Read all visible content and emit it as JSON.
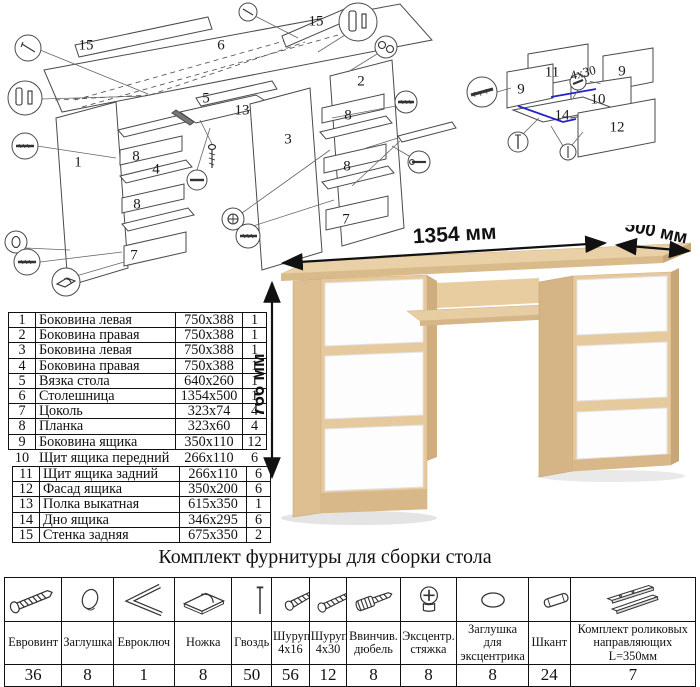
{
  "exploded_main": {
    "labels": [
      {
        "t": "15",
        "x": 86,
        "y": 46
      },
      {
        "t": "6",
        "x": 221,
        "y": 46
      },
      {
        "t": "15",
        "x": 316,
        "y": 22
      },
      {
        "t": "2",
        "x": 361,
        "y": 82
      },
      {
        "t": "5",
        "x": 206,
        "y": 99
      },
      {
        "t": "13",
        "x": 242,
        "y": 111
      },
      {
        "t": "3",
        "x": 288,
        "y": 140
      },
      {
        "t": "1",
        "x": 78,
        "y": 163
      },
      {
        "t": "4",
        "x": 156,
        "y": 170
      },
      {
        "t": "8",
        "x": 136,
        "y": 157
      },
      {
        "t": "8",
        "x": 137,
        "y": 205
      },
      {
        "t": "7",
        "x": 134,
        "y": 256
      },
      {
        "t": "8",
        "x": 348,
        "y": 116
      },
      {
        "t": "8",
        "x": 347,
        "y": 167
      },
      {
        "t": "7",
        "x": 346,
        "y": 220
      }
    ]
  },
  "exploded_drawer": {
    "labels": [
      {
        "t": "11",
        "x": 97,
        "y": 33
      },
      {
        "t": "9",
        "x": 66,
        "y": 50
      },
      {
        "t": "9",
        "x": 167,
        "y": 32
      },
      {
        "t": "10",
        "x": 143,
        "y": 60
      },
      {
        "t": "14",
        "x": 107,
        "y": 76
      },
      {
        "t": "12",
        "x": 162,
        "y": 88
      }
    ],
    "annotation": "4x30",
    "highlight_color": "#2323cc"
  },
  "parts_table": {
    "rows": [
      {
        "num": "1",
        "name": "Боковина левая",
        "size": "750x388",
        "qty": "1"
      },
      {
        "num": "2",
        "name": "Боковина правая",
        "size": "750x388",
        "qty": "1"
      },
      {
        "num": "3",
        "name": "Боковина левая",
        "size": "750x388",
        "qty": "1"
      },
      {
        "num": "4",
        "name": "Боковина правая",
        "size": "750x388",
        "qty": "1"
      },
      {
        "num": "5",
        "name": "Вязка стола",
        "size": "640x260",
        "qty": "1"
      },
      {
        "num": "6",
        "name": "Столешница",
        "size": "1354x500",
        "qty": "1"
      },
      {
        "num": "7",
        "name": "Цоколь",
        "size": "323x74",
        "qty": "4"
      },
      {
        "num": "8",
        "name": "Планка",
        "size": "323x60",
        "qty": "4"
      },
      {
        "num": "9",
        "name": "Боковина ящика",
        "size": "350x110",
        "qty": "12"
      },
      {
        "num": "10",
        "name": "Щит ящика передний",
        "size": "266x110",
        "qty": "6"
      },
      {
        "num": "11",
        "name": "Щит ящика задний",
        "size": "266x110",
        "qty": "6"
      },
      {
        "num": "12",
        "name": "Фасад ящика",
        "size": "350x200",
        "qty": "6"
      },
      {
        "num": "13",
        "name": "Полка выкатная",
        "size": "615x350",
        "qty": "1"
      },
      {
        "num": "14",
        "name": "Дно ящика",
        "size": "346x295",
        "qty": "6"
      },
      {
        "num": "15",
        "name": "Стенка задняя",
        "size": "675x350",
        "qty": "2"
      }
    ]
  },
  "desk": {
    "dims": {
      "width": "1354 мм",
      "depth": "500 мм",
      "height": "766 мм"
    },
    "wood_color": "#e6ca9e",
    "front_color": "#fdfdfd"
  },
  "hardware": {
    "title": "Комплект фурнитуры для сборки стола",
    "items": [
      {
        "icon": "euroscrew",
        "name": "Евровинт",
        "qty": "36"
      },
      {
        "icon": "cap",
        "name": "Заглушка",
        "qty": "8"
      },
      {
        "icon": "hexkey",
        "name": "Евроключ",
        "qty": "1"
      },
      {
        "icon": "foot",
        "name": "Ножка",
        "qty": "8"
      },
      {
        "icon": "nail",
        "name": "Гвоздь",
        "qty": "50"
      },
      {
        "icon": "screw_small",
        "name": "Шуруп 4x16",
        "qty": "56"
      },
      {
        "icon": "screw_long",
        "name": "Шуруп 4x30",
        "qty": "12"
      },
      {
        "icon": "dowel_screw",
        "name": "Ввинчив. дюбель",
        "qty": "8"
      },
      {
        "icon": "cam",
        "name": "Эксцентр. стяжка",
        "qty": "8"
      },
      {
        "icon": "cam_cap",
        "name": "Заглушка для эксцентрика",
        "qty": "8"
      },
      {
        "icon": "dowel",
        "name": "Шкант",
        "qty": "24"
      },
      {
        "icon": "slides",
        "name": "Комплект роликовых направляющих L=350мм",
        "qty": "7"
      }
    ]
  }
}
